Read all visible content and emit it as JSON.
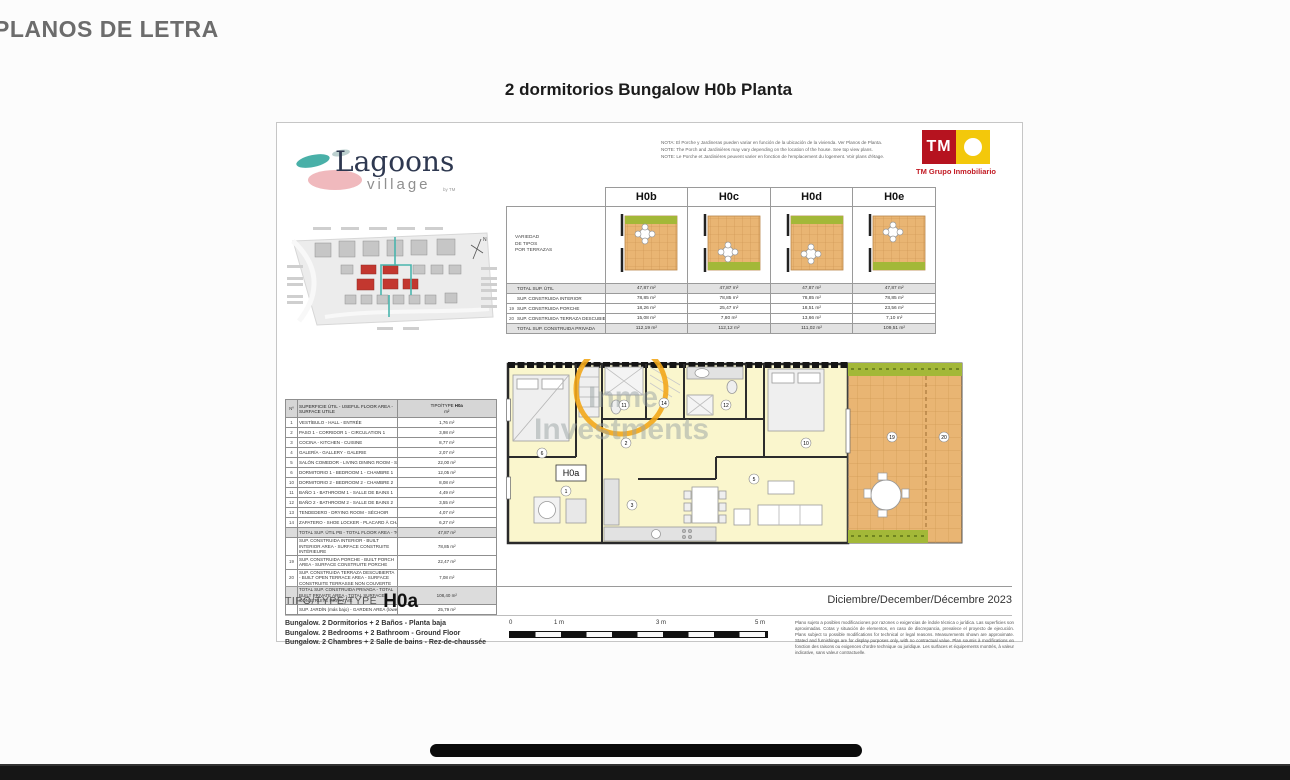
{
  "page": {
    "header": "PLANOS DE LETRA",
    "title": "2 dormitorios Bungalow H0b Planta"
  },
  "sheet": {
    "brand": {
      "name": "Lagoons",
      "sub": "village",
      "by": "by TM"
    },
    "notes": [
      "NOTA: El Porche y Jardineras pueden variar en función de la ubicación de la vivienda. Ver Planos de Planta.",
      "NOTE: The Porch and Jardinières may vary depending on the location of the house. See top view plans.",
      "NOTE: Le Porche et Jardinières peuvent varier en fonction de l'emplacement du logement. Voir plans d'étage."
    ],
    "tm": {
      "abbr": "TM",
      "caption": "TM Grupo Inmobiliario"
    },
    "variants": {
      "corner_label_1": "VARIEDAD",
      "corner_label_2": "DE TIPOS",
      "corner_label_3": "POR TERRAZAS",
      "columns": [
        "H0b",
        "H0c",
        "H0d",
        "H0e"
      ],
      "rows": [
        {
          "num": "",
          "label": "TOTAL SUP. ÚTIL",
          "values": [
            "47,87 m²",
            "47,87 m²",
            "47,87 m²",
            "47,87 m²"
          ]
        },
        {
          "num": "",
          "label": "SUP. CONSTRUIDA INTERIOR",
          "values": [
            "78,85 m²",
            "78,85 m²",
            "78,85 m²",
            "78,85 m²"
          ]
        },
        {
          "num": "19",
          "label": "SUP. CONSTRUIDA PORCHE",
          "values": [
            "18,26 m²",
            "25,47 m²",
            "18,51 m²",
            "23,56 m²"
          ]
        },
        {
          "num": "20",
          "label": "SUP. CONSTRUIDA TERRAZA DESCUBIERTA",
          "values": [
            "15,08 m²",
            "7,80 m²",
            "13,66 m²",
            "7,10 m²"
          ]
        },
        {
          "num": "",
          "label": "TOTAL SUP. CONSTRUIDA PRIVADA",
          "values": [
            "112,19 m²",
            "112,12 m²",
            "111,02 m²",
            "109,51 m²"
          ]
        }
      ]
    },
    "rooms_table": {
      "col_num": "Nº",
      "col_label": "SUPERFICIE ÚTIL - USEFUL FLOOR AREA - SURFACE UTILE",
      "col_type": "TIPO/TYPE",
      "col_type_value": "H0a",
      "col_unit": "m²",
      "rows": [
        [
          "1",
          "VESTÍBULO - HALL - ENTRÉE",
          "1,76 m²"
        ],
        [
          "2",
          "PASO 1 - CORRIDOR 1 - CIRCULATION 1",
          "3,98 m²"
        ],
        [
          "3",
          "COCINA - KITCHEN - CUISINE",
          "8,77 m²"
        ],
        [
          "4",
          "GALERÍA - GALLERY - GALERIE",
          "2,07 m²"
        ],
        [
          "5",
          "SALÓN COMEDOR - LIVING DINING ROOM - SALON SALLE À MANGER",
          "22,00 m²"
        ],
        [
          "6",
          "DORMITORIO 1 - BEDROOM 1 - CHAMBRE 1",
          "12,05 m²"
        ],
        [
          "10",
          "DORMITORIO 2 - BEDROOM 2 - CHAMBRE 2",
          "8,08 m²"
        ],
        [
          "11",
          "BAÑO 1 - BATHROOM 1 - SALLE DE BAINS 1",
          "4,49 m²"
        ],
        [
          "12",
          "BAÑO 2 - BATHROOM 2 - SALLE DE BAINS 2",
          "3,55 m²"
        ],
        [
          "13",
          "TENDEDERO - DRYING ROOM - SÉCHOIR",
          "4,07 m²"
        ],
        [
          "14",
          "ZAPATERO - SHOE LOCKER - PLACARD À CHAUSSURES",
          "6,27 m²"
        ]
      ],
      "totals": [
        {
          "num": "",
          "label": "TOTAL SUP. ÚTIL PB - TOTAL FLOOR AREA - TOTAL SURFACE UTILE",
          "value": "47,87 m²"
        },
        {
          "num": "",
          "label": "SUP. CONSTRUIDA INTERIOR - BUILT INTERIOR AREA - SURFACE CONSTRUITE INTÉRIEURE",
          "value": "78,85 m²"
        },
        {
          "num": "19",
          "label": "SUP. CONSTRUIDA PORCHE - BUILT PORCH AREA - SURFACE CONSTRUITE PORCHE",
          "value": "22,47 m²"
        },
        {
          "num": "20",
          "label": "SUP. CONSTRUIDA TERRAZA DESCUBIERTA - BUILT OPEN TERRACE AREA - SURFACE CONSTRUITE TERRASSE NON COUVERTE",
          "value": "7,08 m²"
        },
        {
          "num": "",
          "label": "TOTAL SUP. CONSTRUIDA PRIVADA - TOTAL BUILT PRIVATE AREA - TOTAL SURFACE CONSTRUITE PRIVATIVE",
          "value": "108,40 m²"
        },
        {
          "num": "",
          "label": "SUP. JARDÍN (más bajo) - GARDEN AREA (lowest) - SURF. JARDIN (au plus bas)",
          "value": "25,79 m²"
        }
      ]
    },
    "site_plan": {
      "compass": "N"
    },
    "plan": {
      "unit_label": "H0a",
      "watermark_line1": "Inme",
      "watermark_line2": "Investments",
      "markers": {
        "m1": "1",
        "m2": "2",
        "m3": "3",
        "m5": "5",
        "m6": "6",
        "m10": "10",
        "m11": "11",
        "m12": "12",
        "m14": "14",
        "m19": "19",
        "m20": "20"
      }
    },
    "footer": {
      "type_label": "TIPO/TYPE/TYPE",
      "type_value": "H0a",
      "date": "Diciembre/December/Décembre 2023",
      "descriptions": [
        "Bungalow. 2 Dormitorios + 2 Baños - Planta baja",
        "Bungalow. 2 Bedrooms + 2 Bathroom - Ground Floor",
        "Bungalow. 2 Chambres + 2 Salle de bains - Rez-de-chaussée"
      ],
      "scale_ticks": [
        "0",
        "1 m",
        "3 m",
        "5 m"
      ],
      "disclaimer": [
        "Plano sujeto a posibles modificaciones por razones o exigencias de índole técnica o jurídica. Las superficies son aproximadas. Cotas y situación de elementos, en caso de discrepancia, prevalece el proyecto de ejecución.",
        "Plans subject to possible modifications for technical or legal reasons. Measurements shown are approximate. Stated and furnishings are for display purposes only, with no contractual value.",
        "Plan soumis à modifications en fonction des raisons ou exigences d'ordre technique ou juridique. Les surfaces et équipements montrés, à valeur indicative, sans valeur contractuelle."
      ]
    }
  }
}
